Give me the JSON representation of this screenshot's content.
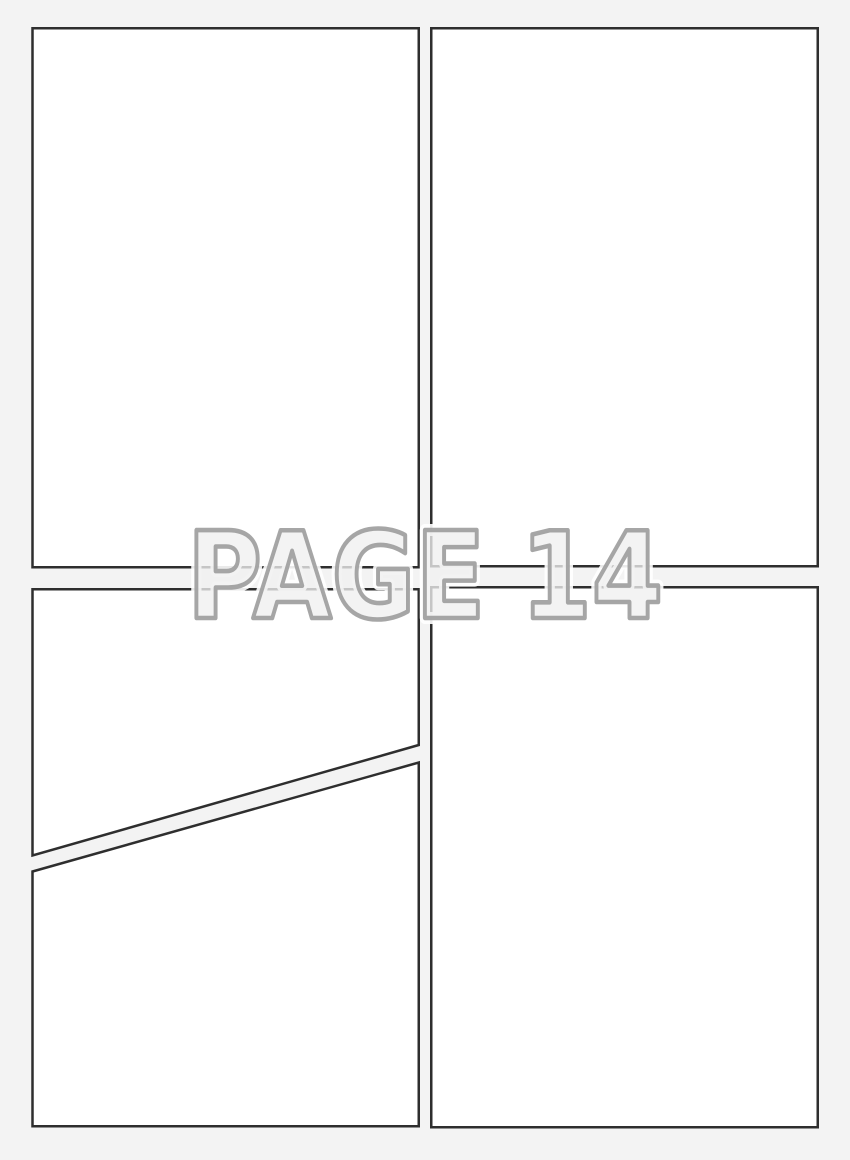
{
  "page": {
    "background_color": "#f3f3f3"
  },
  "watermark": {
    "text": "PAGE 14",
    "fill_color": "#efefef",
    "outline_color": "#9e9e9e",
    "halo_color": "#ffffff"
  },
  "panels": {
    "count": 5,
    "fill_color": "#ffffff",
    "border_color": "#2e2e2e",
    "items": [
      {
        "id": "panel-top-left"
      },
      {
        "id": "panel-top-right"
      },
      {
        "id": "panel-middle-left-diagonal"
      },
      {
        "id": "panel-bottom-left-diagonal"
      },
      {
        "id": "panel-bottom-right"
      }
    ]
  }
}
